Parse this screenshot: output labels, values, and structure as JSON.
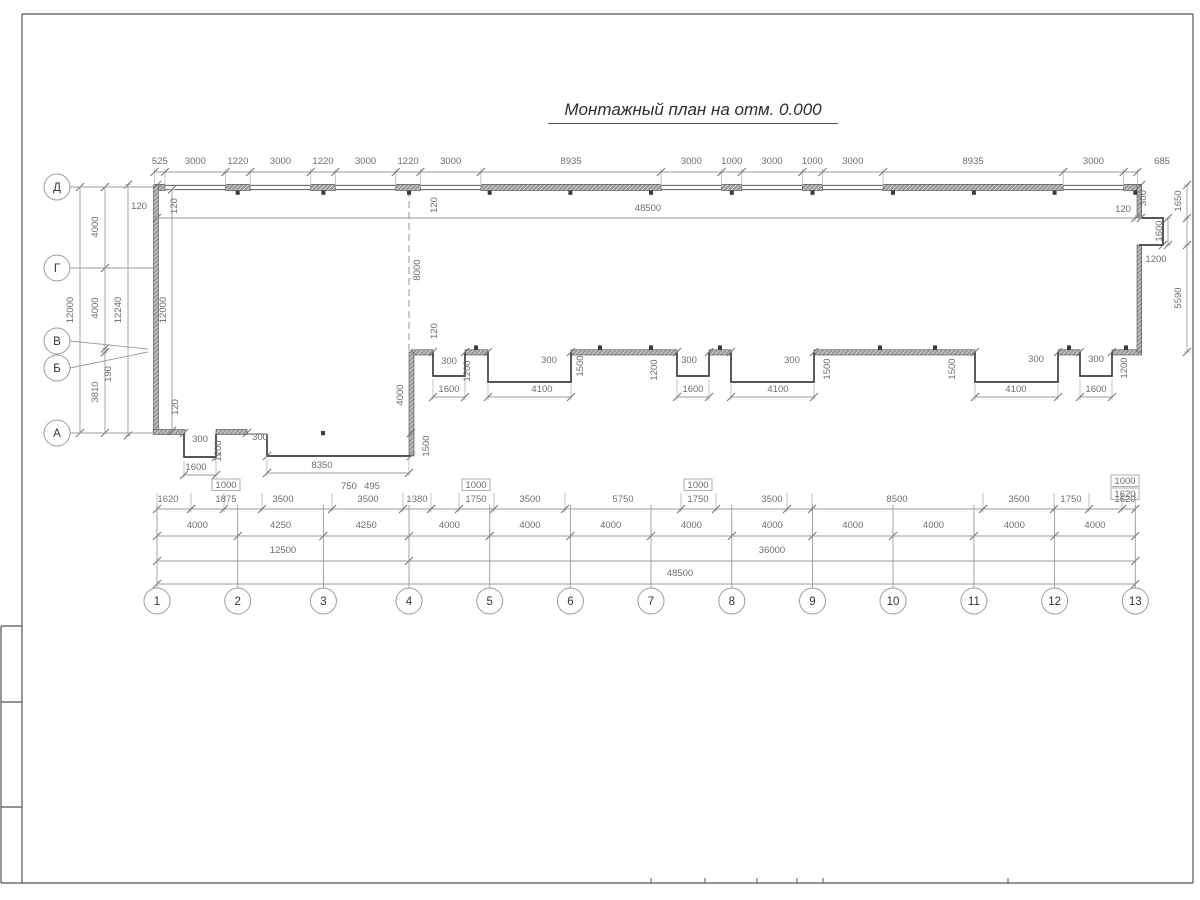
{
  "title": "Монтажный план на отм. 0.000",
  "colors": {
    "wall": "#3f3f3f",
    "panel_fill": "#9a9a9a",
    "dim_line": "#9b9b9b",
    "dim_text": "#6e6e6e",
    "frame": "#555555"
  },
  "axes": {
    "rows": [
      {
        "label": "Д",
        "cy": 187
      },
      {
        "label": "Г",
        "cy": 268
      },
      {
        "label": "В",
        "cy": 341
      },
      {
        "label": "Б",
        "cy": 368
      },
      {
        "label": "А",
        "cy": 433
      }
    ],
    "row_leaders": [
      [
        70,
        187,
        153,
        187
      ],
      [
        70,
        268,
        153,
        268
      ],
      [
        70,
        341,
        148,
        349
      ],
      [
        70,
        368,
        148,
        352
      ],
      [
        70,
        433,
        153,
        433
      ]
    ],
    "columns": [
      {
        "label": "1",
        "cx": 157
      },
      {
        "label": "2",
        "cx": 237.7
      },
      {
        "label": "3",
        "cx": 323.4
      },
      {
        "label": "4",
        "cx": 409
      },
      {
        "label": "5",
        "cx": 489.7
      },
      {
        "label": "6",
        "cx": 570.4
      },
      {
        "label": "7",
        "cx": 651
      },
      {
        "label": "8",
        "cx": 731.8
      },
      {
        "label": "9",
        "cx": 812.5
      },
      {
        "label": "10",
        "cx": 893
      },
      {
        "label": "11",
        "cx": 973.9
      },
      {
        "label": "12",
        "cx": 1054.6
      },
      {
        "label": "13",
        "cx": 1135.3
      }
    ],
    "col_circle_y": 601,
    "row_circle_x": 57,
    "radius": 13
  },
  "chains_h": [
    {
      "y": 172,
      "ext": [
        3,
        14
      ],
      "pts": [
        154.5,
        165,
        225.6,
        250.2,
        310.7,
        335.3,
        395.8,
        420.4,
        480.9,
        661.1,
        721.6,
        741.8,
        802.3,
        822.5,
        883,
        1063.2,
        1123.7,
        1137.5
      ],
      "labels": [
        [
          "525",
          159.8,
          164
        ],
        [
          "3000",
          195.4,
          164
        ],
        [
          "1220",
          237.9,
          164
        ],
        [
          "3000",
          280.5,
          164
        ],
        [
          "1220",
          323,
          164
        ],
        [
          "3000",
          365.6,
          164
        ],
        [
          "1220",
          408.1,
          164
        ],
        [
          "3000",
          450.7,
          164
        ],
        [
          "8935",
          571,
          164
        ],
        [
          "3000",
          691.4,
          164
        ],
        [
          "1000",
          731.7,
          164
        ],
        [
          "3000",
          772.1,
          164
        ],
        [
          "1000",
          812.4,
          164
        ],
        [
          "3000",
          852.8,
          164
        ],
        [
          "8935",
          973.1,
          164
        ],
        [
          "3000",
          1093.5,
          164
        ],
        [
          "685",
          1162,
          164
        ]
      ]
    },
    {
      "y": 218,
      "ext": [
        3,
        3
      ],
      "pts": [
        157,
        1135.3
      ],
      "labels": [
        [
          "48500",
          648,
          211
        ]
      ]
    },
    {
      "y": 509,
      "ext": [
        16,
        3
      ],
      "pts": [
        157,
        191,
        224,
        262,
        332,
        403,
        431,
        459,
        494,
        565,
        681,
        716,
        787,
        812,
        983,
        1054,
        1089,
        1122,
        1135.3
      ],
      "labels": [
        [
          "1620",
          168,
          502
        ],
        [
          "1875",
          226,
          502
        ],
        [
          "3500",
          283,
          502
        ],
        [
          "3500",
          368,
          502
        ],
        [
          "1380",
          417,
          502
        ],
        [
          "1750",
          476,
          502
        ],
        [
          "3500",
          530,
          502
        ],
        [
          "5750",
          623,
          502
        ],
        [
          "1750",
          698,
          502
        ],
        [
          "3500",
          772,
          502
        ],
        [
          "8500",
          897,
          502
        ],
        [
          "3500",
          1019,
          502
        ],
        [
          "1750",
          1071,
          502
        ],
        [
          "1620",
          1125,
          502
        ]
      ]
    },
    {
      "y": 536,
      "ext": [
        12,
        3
      ],
      "pts": [
        157,
        237.7,
        323.4,
        409,
        489.7,
        570.4,
        651,
        731.8,
        812.5,
        893,
        973.9,
        1054.6,
        1135.3
      ],
      "labels": [
        [
          "4000",
          197.3,
          528
        ],
        [
          "4250",
          280.6,
          528
        ],
        [
          "4250",
          366.2,
          528
        ],
        [
          "4000",
          449.4,
          528
        ],
        [
          "4000",
          530,
          528
        ],
        [
          "4000",
          610.7,
          528
        ],
        [
          "4000",
          691.4,
          528
        ],
        [
          "4000",
          772.2,
          528
        ],
        [
          "4000",
          852.8,
          528
        ],
        [
          "4000",
          933.5,
          528
        ],
        [
          "4000",
          1014.3,
          528
        ],
        [
          "4000",
          1095,
          528
        ]
      ]
    },
    {
      "y": 561,
      "ext": [
        3,
        3
      ],
      "pts": [
        157,
        409,
        1135.3
      ],
      "labels": [
        [
          "12500",
          283,
          553
        ],
        [
          "36000",
          772,
          553
        ]
      ]
    },
    {
      "y": 584,
      "ext": [
        3,
        3
      ],
      "pts": [
        157,
        1135.3
      ],
      "labels": [
        [
          "48500",
          680,
          576
        ]
      ]
    },
    {
      "y": 397,
      "ext": [
        18,
        3
      ],
      "pts": [
        433,
        465
      ],
      "labels": [
        [
          "1600",
          449,
          392
        ]
      ]
    },
    {
      "y": 397,
      "ext": [
        13,
        3
      ],
      "pts": [
        488,
        571
      ],
      "labels": [
        [
          "4100",
          542,
          392
        ]
      ]
    },
    {
      "y": 397,
      "ext": [
        18,
        3
      ],
      "pts": [
        677,
        709
      ],
      "labels": [
        [
          "1600",
          693,
          392
        ]
      ]
    },
    {
      "y": 397,
      "ext": [
        13,
        3
      ],
      "pts": [
        731,
        814
      ],
      "labels": [
        [
          "4100",
          778,
          392
        ]
      ]
    },
    {
      "y": 397,
      "ext": [
        13,
        3
      ],
      "pts": [
        975,
        1058
      ],
      "labels": [
        [
          "4100",
          1016,
          392
        ]
      ]
    },
    {
      "y": 397,
      "ext": [
        18,
        3
      ],
      "pts": [
        1080,
        1112
      ],
      "labels": [
        [
          "1600",
          1096,
          392
        ]
      ]
    },
    {
      "y": 475,
      "ext": [
        14,
        3
      ],
      "pts": [
        184,
        216
      ],
      "labels": [
        [
          "1600",
          196,
          470
        ]
      ]
    },
    {
      "y": 473,
      "ext": [
        14,
        3
      ],
      "pts": [
        267,
        409
      ],
      "labels": [
        [
          "8350",
          322,
          468
        ]
      ]
    }
  ],
  "chains_v": [
    {
      "x": 80,
      "ext": [
        3,
        3
      ],
      "pts": [
        187,
        433
      ],
      "labels": [
        [
          "12000",
          73,
          310
        ]
      ]
    },
    {
      "x": 105,
      "ext": [
        3,
        3
      ],
      "pts": [
        187,
        268,
        348.4,
        352.2,
        433
      ],
      "labels": [
        [
          "4000",
          98,
          227
        ],
        [
          "4000",
          98,
          308
        ],
        [
          "3810",
          98,
          392
        ]
      ]
    },
    {
      "x": 128,
      "ext": [
        3,
        3
      ],
      "pts": [
        184.5,
        435.5
      ],
      "labels": [
        [
          "12240",
          121,
          310
        ]
      ]
    },
    {
      "x": 172,
      "ext": [
        3,
        3
      ],
      "pts": [
        189.5,
        431
      ],
      "labels": []
    },
    {
      "x": 1187,
      "ext": [
        3,
        3
      ],
      "pts": [
        185,
        218,
        245,
        352
      ],
      "labels": [
        [
          "1650",
          1181,
          201
        ],
        [
          "5590",
          1181,
          298
        ]
      ]
    },
    {
      "x": 1168,
      "ext": [
        3,
        3
      ],
      "pts": [
        218,
        245
      ],
      "labels": [
        [
          "1600",
          1162,
          231
        ]
      ]
    }
  ],
  "free_labels": [
    [
      "120",
      139,
      209,
      0
    ],
    [
      "120",
      177,
      206,
      1
    ],
    [
      "12000",
      166,
      310,
      1
    ],
    [
      "120",
      437,
      205,
      1
    ],
    [
      "8000",
      420,
      270,
      1
    ],
    [
      "120",
      437,
      331,
      1
    ],
    [
      "4000",
      403,
      395,
      1
    ],
    [
      "1500",
      429,
      446,
      1
    ],
    [
      "120",
      178,
      407,
      1
    ],
    [
      "190",
      111,
      374,
      1
    ],
    [
      "300",
      1146,
      198,
      1
    ],
    [
      "120",
      1123,
      212,
      0
    ],
    [
      "1200",
      1156,
      262,
      0
    ],
    [
      "300",
      200,
      442,
      0
    ],
    [
      "1200",
      221,
      451,
      1
    ],
    [
      "300",
      260,
      440,
      0
    ],
    [
      "300",
      449,
      364,
      0
    ],
    [
      "1200",
      470,
      371,
      1
    ],
    [
      "300",
      549,
      363,
      0
    ],
    [
      "1500",
      583,
      366,
      1
    ],
    [
      "1200",
      657,
      370,
      1
    ],
    [
      "300",
      689,
      363,
      0
    ],
    [
      "300",
      792,
      363,
      0
    ],
    [
      "1500",
      830,
      369,
      1
    ],
    [
      "1500",
      955,
      369,
      1
    ],
    [
      "300",
      1036,
      362,
      0
    ],
    [
      "300",
      1096,
      362,
      0
    ],
    [
      "1200",
      1127,
      368,
      1
    ]
  ],
  "boxes": [
    [
      "1000",
      226,
      488
    ],
    [
      "1000",
      476,
      488
    ],
    [
      "1000",
      698,
      488
    ],
    [
      "1000",
      1125,
      484
    ],
    [
      "1620",
      1125,
      497
    ]
  ],
  "small_labels": [
    [
      "750",
      349,
      489
    ],
    [
      "495",
      372,
      489
    ]
  ],
  "walls": {
    "thin_lines": [
      [
        154.5,
        185.4,
        1141.5,
        185.4
      ],
      [
        154.5,
        189.6,
        1141.5,
        189.6
      ],
      [
        247,
        434,
        267,
        434
      ]
    ],
    "panels_top": {
      "y": 184.3,
      "h": 6.2,
      "spans": [
        [
          154.5,
          165
        ],
        [
          225.6,
          250.2
        ],
        [
          310.7,
          335.3
        ],
        [
          395.8,
          420.4
        ],
        [
          480.9,
          661.1
        ],
        [
          721.6,
          741.8
        ],
        [
          802.3,
          822.5
        ],
        [
          883,
          1063.2
        ],
        [
          1123.7,
          1141.5
        ]
      ]
    },
    "panels_bottom": {
      "y": 349.8,
      "h": 5.2,
      "spans": [
        [
          411,
          433
        ],
        [
          465,
          488
        ],
        [
          571,
          677
        ],
        [
          709,
          731
        ],
        [
          814,
          975
        ],
        [
          1058,
          1080
        ],
        [
          1112,
          1141.5
        ]
      ]
    },
    "bands_v": [
      {
        "x": 153.5,
        "w": 5,
        "y1": 185,
        "y2": 433
      },
      {
        "x": 409,
        "w": 5,
        "y1": 352,
        "y2": 456
      },
      {
        "x": 1137,
        "w": 4.7,
        "y1": 185,
        "y2": 218
      },
      {
        "x": 1137,
        "w": 4.7,
        "y1": 245,
        "y2": 352
      }
    ],
    "bands_h": [
      {
        "y": 429.5,
        "h": 5,
        "x1": 153.5,
        "x2": 185
      },
      {
        "y": 429.5,
        "h": 5,
        "x1": 216,
        "x2": 247
      }
    ],
    "outlines": [
      [
        [
          184,
          434
        ],
        [
          184,
          457
        ],
        [
          216,
          457
        ],
        [
          216,
          434
        ]
      ],
      [
        [
          267,
          434
        ],
        [
          267,
          456
        ],
        [
          411,
          456
        ]
      ],
      [
        [
          433,
          352
        ],
        [
          433,
          376
        ],
        [
          465,
          376
        ],
        [
          465,
          352
        ]
      ],
      [
        [
          488,
          352
        ],
        [
          488,
          382
        ],
        [
          571,
          382
        ],
        [
          571,
          352
        ]
      ],
      [
        [
          677,
          352
        ],
        [
          677,
          376
        ],
        [
          709,
          376
        ],
        [
          709,
          352
        ]
      ],
      [
        [
          731,
          352
        ],
        [
          731,
          382
        ],
        [
          814,
          382
        ],
        [
          814,
          352
        ]
      ],
      [
        [
          975,
          352
        ],
        [
          975,
          382
        ],
        [
          1058,
          382
        ],
        [
          1058,
          352
        ]
      ],
      [
        [
          1080,
          352
        ],
        [
          1080,
          376
        ],
        [
          1112,
          376
        ],
        [
          1112,
          352
        ]
      ],
      [
        [
          1141.5,
          218
        ],
        [
          1163,
          218
        ],
        [
          1163,
          245
        ],
        [
          1139,
          245
        ]
      ]
    ],
    "dashed": [
      [
        409,
        190,
        409,
        454
      ]
    ],
    "tabs_below_top": [
      237.7,
      323.4,
      409,
      489.7,
      570.4,
      651,
      731.8,
      812.5,
      893,
      973.9,
      1054.6,
      1135.3
    ],
    "tabs_above_bottom": [
      476,
      600,
      651,
      720,
      880,
      935,
      1069,
      1126
    ],
    "tabs_misc": [
      [
        323,
        431
      ]
    ]
  },
  "extra_ticks": [
    [
      433,
      352
    ],
    [
      465,
      352
    ],
    [
      488,
      352
    ],
    [
      571,
      352
    ],
    [
      677,
      352
    ],
    [
      709,
      352
    ],
    [
      731,
      352
    ],
    [
      814,
      352
    ],
    [
      975,
      352
    ],
    [
      1058,
      352
    ],
    [
      1080,
      352
    ],
    [
      1112,
      352
    ],
    [
      184,
      433
    ],
    [
      216,
      457
    ],
    [
      247,
      433
    ],
    [
      267,
      456
    ],
    [
      411,
      433
    ],
    [
      411,
      456
    ],
    [
      1141,
      218
    ],
    [
      1163,
      245
    ],
    [
      157,
      185
    ],
    [
      1141,
      185
    ]
  ],
  "frame": {
    "lines": [
      [
        22,
        14,
        1193,
        14
      ],
      [
        22,
        14,
        22,
        883
      ],
      [
        1193,
        14,
        1193,
        883
      ],
      [
        22,
        883,
        1193,
        883
      ],
      [
        1,
        626,
        22,
        626
      ],
      [
        1,
        702,
        22,
        702
      ],
      [
        1,
        807,
        22,
        807
      ],
      [
        1,
        626,
        1,
        883
      ],
      [
        1,
        883,
        22,
        883
      ]
    ],
    "stubs_x": [
      651,
      705,
      757,
      797,
      823,
      1008
    ],
    "stubs_y1": 878,
    "stubs_y2": 883
  }
}
